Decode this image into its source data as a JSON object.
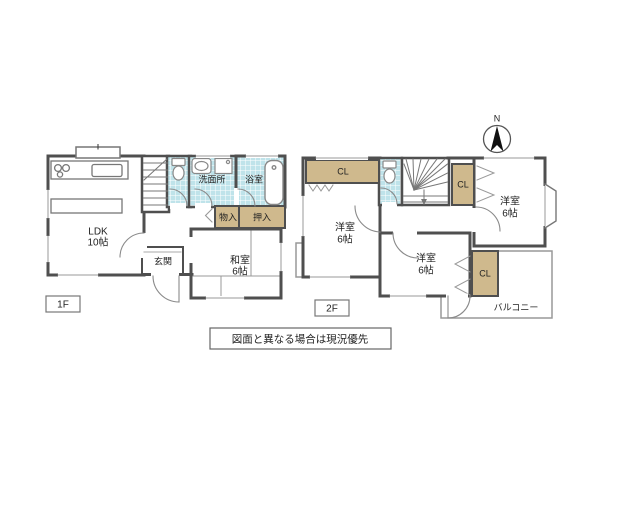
{
  "floors": {
    "f1": {
      "label": "1F",
      "ldk": {
        "name": "LDK",
        "size": "10帖"
      },
      "washroom": "洗面所",
      "bath": "浴室",
      "storage": "物入",
      "oshiire": "押入",
      "entrance": "玄関",
      "washitsu": {
        "name": "和室",
        "size": "6帖"
      }
    },
    "f2": {
      "label": "2F",
      "closets": [
        "CL",
        "CL",
        "CL"
      ],
      "rooms": [
        {
          "name": "洋室",
          "size": "6帖"
        },
        {
          "name": "洋室",
          "size": "6帖"
        },
        {
          "name": "洋室",
          "size": "6帖"
        }
      ],
      "balcony": "バルコニー"
    }
  },
  "compass": {
    "label": "N"
  },
  "note": "図面と異なる場合は現況優先",
  "colors": {
    "wall": "#4f4f4f",
    "closet": "#cfb98d",
    "wet_area": "#bfe3ea",
    "thin_line": "#999999",
    "needle": "#111111"
  }
}
